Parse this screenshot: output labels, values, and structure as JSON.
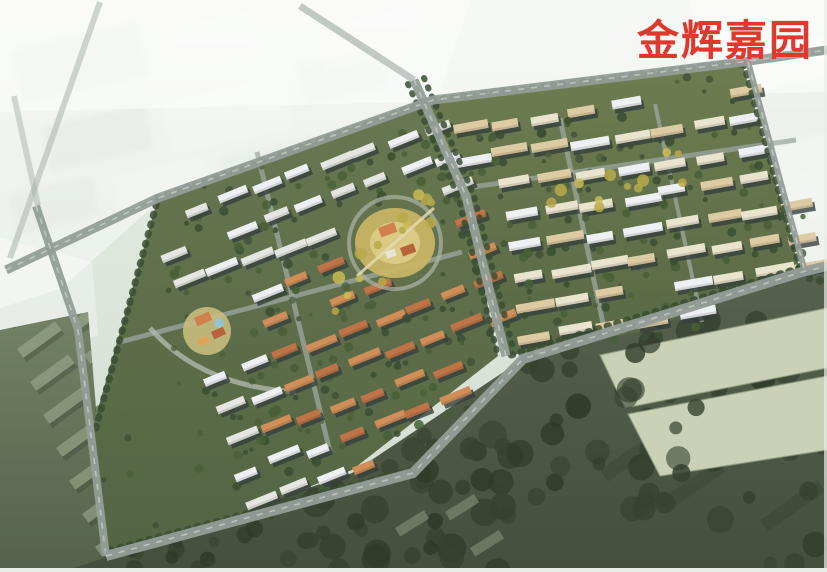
{
  "title": {
    "text": "金辉嘉园",
    "color": "#df392e"
  },
  "scene": {
    "width": 827,
    "height": 572,
    "seed": 13,
    "palette": {
      "haze_top": "#ecf1ea",
      "haze_mid": "#dce6db",
      "haze_bot": "#cfdacd",
      "haze_block": "#c7d3c9",
      "haze_white": "#eef3ee",
      "haze_road": "#a7b1a9",
      "lowland_top": "#6e7d5f",
      "lowland_bot": "#4e5c44",
      "lowland_slab": "#9cab8d",
      "lowland_shadow": "#323d2c",
      "forest_top": "#505c46",
      "forest_bot": "#3d4937",
      "forest_tree": "#2f3b28",
      "forest_tree_dark": "#273320",
      "site_w_top": "#62734a",
      "site_w_bot": "#4d5e3c",
      "site_e_top": "#687849",
      "site_e_bot": "#52633f",
      "tree_dark": "#33462b",
      "tree_mid": "#41582f",
      "tree_yellow": "#b5a743",
      "tree_yellow2": "#c9b94e",
      "roof_white": "#eef1f4",
      "roof_light": "#e3e7e0",
      "roof_cream": "#e9e3cd",
      "roof_tan": "#dcc9a0",
      "roof_orange": "#cf8a52",
      "roof_orange_dark": "#bc6f40",
      "wall_shadow": "#2e3835",
      "road_gray": "#8f9a94",
      "road_minor": "#9aa49c",
      "road_curve": "#aeb6aa",
      "plaza_outer": "#c9b35f",
      "plaza_inner": "#dbc981",
      "plaza_ring": "#a9b2a4",
      "plaza_path": "#e3d9ad",
      "pav1": "#cf7b43",
      "pav2": "#b35c33",
      "pav3": "#e7e3d2",
      "pav4": "#e0a14e",
      "pool": "#8fc3d4",
      "kinder_base": "#c6b97b",
      "warehouse": "#c7d1b4",
      "warehouse_shade": "#8d9a7e",
      "wash": "#ffffff",
      "border": "#e9ece8"
    },
    "haze": {
      "blocks": [
        [
          15,
          35,
          130,
          55,
          -13,
          "haze_block",
          0.5
        ],
        [
          165,
          18,
          95,
          48,
          -13,
          "haze_white",
          0.5
        ],
        [
          45,
          115,
          105,
          45,
          -13,
          "haze_block",
          0.45
        ],
        [
          165,
          90,
          125,
          52,
          -13,
          "haze_white",
          0.45
        ],
        [
          300,
          55,
          85,
          42,
          -13,
          "haze_block",
          0.4
        ],
        [
          12,
          185,
          85,
          40,
          -13,
          "haze_block",
          0.4
        ],
        [
          115,
          165,
          95,
          45,
          -13,
          "haze_white",
          0.4
        ],
        [
          225,
          145,
          100,
          48,
          -13,
          "haze_block",
          0.35
        ],
        [
          320,
          15,
          95,
          45,
          -13,
          "haze_white",
          0.4
        ],
        [
          335,
          120,
          80,
          40,
          -13,
          "haze_block",
          0.3
        ],
        [
          755,
          85,
          75,
          55,
          -13,
          "haze_block",
          0.35
        ],
        [
          762,
          175,
          65,
          48,
          -13,
          "haze_white",
          0.35
        ]
      ],
      "washes": [
        {
          "pts": [
            [
              0,
              0
            ],
            [
              827,
              0
            ],
            [
              827,
              92
            ],
            [
              0,
              112
            ]
          ],
          "op": 0.5
        },
        {
          "pts": [
            [
              0,
              0
            ],
            [
              470,
              0
            ],
            [
              436,
              104
            ],
            [
              162,
              198
            ],
            [
              62,
              288
            ],
            [
              0,
              308
            ]
          ],
          "op": 0.45
        },
        {
          "pts": [
            [
              0,
              238
            ],
            [
              92,
              262
            ],
            [
              98,
              336
            ],
            [
              0,
              352
            ]
          ],
          "op": 0.35
        },
        {
          "pts": [
            [
              738,
              52
            ],
            [
              827,
              38
            ],
            [
              827,
              278
            ],
            [
              798,
              272
            ]
          ],
          "op": 0.5
        },
        {
          "pts": [
            [
              690,
              0
            ],
            [
              827,
              0
            ],
            [
              827,
              60
            ],
            [
              700,
              62
            ]
          ],
          "op": 0.45
        }
      ],
      "roads": [
        [
          10,
          258,
          100,
          2,
          6,
          0.55
        ],
        [
          38,
          206,
          14,
          96,
          6,
          0.5
        ],
        [
          300,
          6,
          414,
          80,
          7,
          0.7
        ]
      ]
    },
    "lowland": {
      "poly": [
        [
          0,
          330
        ],
        [
          88,
          312
        ],
        [
          98,
          432
        ],
        [
          106,
          558
        ],
        [
          60,
          572
        ],
        [
          0,
          572
        ]
      ],
      "slabs": {
        "rows": 8,
        "cols": 3,
        "x0": 4,
        "y0": 316,
        "dxRow": 13,
        "dyRow": 33,
        "dxCol": 54,
        "dyCol": -27,
        "w": 47,
        "h": 11,
        "rot": -36
      }
    },
    "forest": {
      "poly": [
        [
          60,
          572
        ],
        [
          104,
          558
        ],
        [
          352,
          473
        ],
        [
          523,
          359
        ],
        [
          802,
          272
        ],
        [
          827,
          266
        ],
        [
          827,
          572
        ]
      ],
      "clusters": [
        {
          "n": 40,
          "x": [
            295,
            520
          ],
          "y": [
            430,
            572
          ],
          "r": [
            7,
            15
          ]
        },
        {
          "n": 45,
          "x": [
            520,
            827
          ],
          "y": [
            300,
            572
          ],
          "r": [
            6,
            14
          ]
        },
        {
          "n": 14,
          "x": [
            90,
            300
          ],
          "y": [
            470,
            572
          ],
          "r": [
            4,
            9
          ]
        }
      ],
      "shadow_streaks": [
        [
          600,
          470
        ],
        [
          660,
          500
        ],
        [
          710,
          450
        ],
        [
          760,
          520
        ]
      ],
      "small_slabs": [
        [
          395,
          528
        ],
        [
          445,
          512
        ],
        [
          470,
          548
        ]
      ],
      "warehouses": [
        [
          [
            600,
            355
          ],
          [
            827,
            308
          ],
          [
            827,
            368
          ],
          [
            625,
            408
          ]
        ],
        [
          [
            628,
            414
          ],
          [
            827,
            376
          ],
          [
            827,
            450
          ],
          [
            660,
            476
          ]
        ]
      ],
      "warehouse_trees": {
        "n": 16,
        "x": [
          548,
          700
        ],
        "y": [
          330,
          500
        ]
      }
    },
    "site": {
      "west": {
        "poly": [
          [
            92,
            430
          ],
          [
            158,
            198
          ],
          [
            433,
            100
          ],
          [
            468,
            208
          ],
          [
            498,
            356
          ],
          [
            352,
            470
          ],
          [
            240,
            514
          ],
          [
            106,
            556
          ]
        ],
        "origin": [
          150,
          222
        ],
        "u": [
          34,
          -11.7
        ],
        "v": [
          10.8,
          31.2
        ],
        "rows": 11,
        "cols": 10,
        "angle": -22,
        "barW": [
          22,
          34
        ],
        "barH": 8,
        "jitter": 3.5,
        "skip": 0.1,
        "fills": [
          "roof_white",
          "roof_light"
        ],
        "orange_poly": [
          [
            258,
            256
          ],
          [
            470,
            206
          ],
          [
            500,
            354
          ],
          [
            352,
            468
          ],
          [
            260,
            428
          ]
        ],
        "orange_fills": [
          "roof_orange",
          "roof_orange_dark"
        ],
        "exclude": [
          [
            395,
            243,
            50
          ],
          [
            207,
            331,
            30
          ]
        ],
        "extra_trees": 55
      },
      "east": {
        "poly": [
          [
            433,
            100
          ],
          [
            742,
            62
          ],
          [
            800,
            270
          ],
          [
            640,
            332
          ],
          [
            506,
            356
          ]
        ],
        "origin": [
          450,
          126
        ],
        "u": [
          39.6,
          -5.6
        ],
        "v": [
          4.3,
          30.7
        ],
        "rows": 9,
        "cols": 9,
        "angle": -10,
        "barW": [
          26,
          40
        ],
        "barH": 9,
        "jitter": 3.5,
        "skip": 0.1,
        "fills": [
          "roof_cream",
          "roof_white",
          "roof_tan"
        ],
        "orange_poly": null,
        "orange_fills": [],
        "exclude": [
          [
            395,
            243,
            52
          ]
        ],
        "extra_trees": 55
      },
      "belts": [
        {
          "pts": [
            [
              158,
              198
            ],
            [
              433,
              100
            ]
          ],
          "w": 7
        },
        {
          "pts": [
            [
              96,
              428
            ],
            [
              158,
              198
            ]
          ],
          "w": 7
        },
        {
          "pts": [
            [
              110,
              550
            ],
            [
              410,
              470
            ]
          ],
          "w": 7
        },
        {
          "pts": [
            [
              433,
              100
            ],
            [
              742,
              62
            ]
          ],
          "w": 7
        },
        {
          "pts": [
            [
              744,
              64
            ],
            [
              800,
              268
            ]
          ],
          "w": 7
        },
        {
          "pts": [
            [
              800,
              268
            ],
            [
              508,
              356
            ]
          ],
          "w": 7
        },
        {
          "pts": [
            [
              408,
              84
            ],
            [
              458,
              196
            ],
            [
              498,
              356
            ]
          ],
          "w": 6
        },
        {
          "pts": [
            [
              424,
              78
            ],
            [
              474,
              196
            ],
            [
              514,
              352
            ]
          ],
          "w": 6
        }
      ],
      "roads_major": [
        {
          "pts": [
            [
              6,
              270
            ],
            [
              158,
              198
            ],
            [
              433,
              100
            ],
            [
              742,
              62
            ],
            [
              827,
              50
            ]
          ],
          "w": 9
        },
        {
          "pts": [
            [
              36,
              206
            ],
            [
              78,
              330
            ],
            [
              106,
              556
            ]
          ],
          "w": 8
        },
        {
          "pts": [
            [
              106,
              556
            ],
            [
              413,
              473
            ],
            [
              523,
              359
            ],
            [
              802,
              272
            ],
            [
              827,
              266
            ]
          ],
          "w": 10
        },
        {
          "pts": [
            [
              414,
              80
            ],
            [
              466,
              196
            ],
            [
              506,
              356
            ]
          ],
          "w": 9
        },
        {
          "pts": [
            [
              748,
              62
            ],
            [
              804,
              268
            ]
          ],
          "w": 6
        }
      ],
      "roads_minor": [
        {
          "pts": [
            [
              120,
              342
            ],
            [
              462,
              252
            ]
          ],
          "w": 5
        },
        {
          "pts": [
            [
              257,
              152
            ],
            [
              330,
              452
            ]
          ],
          "w": 5
        },
        {
          "pts": [
            [
              452,
              190
            ],
            [
              796,
              140
            ]
          ],
          "w": 5
        },
        {
          "pts": [
            [
              560,
              118
            ],
            [
              606,
              338
            ]
          ],
          "w": 5
        },
        {
          "pts": [
            [
              655,
              104
            ],
            [
              702,
              322
            ]
          ],
          "w": 4
        }
      ],
      "curve_road": "M150,328 Q200,386 296,392",
      "plaza": {
        "cx": 395,
        "cy": 243,
        "ring_r": 46,
        "rx": 40,
        "ry": 35,
        "irx": 25,
        "iry": 21,
        "pav": [
          [
            378,
            228,
            17,
            10
          ],
          [
            400,
            248,
            14,
            9
          ],
          [
            385,
            252,
            10,
            7
          ]
        ],
        "pav_rot": -20,
        "path": [
          [
            357,
            276
          ],
          [
            434,
            208
          ]
        ]
      },
      "kinder": {
        "cx": 207,
        "cy": 331,
        "r": 24,
        "pav": [
          [
            194,
            318,
            16,
            9
          ],
          [
            211,
            332,
            13,
            8
          ],
          [
            197,
            340,
            11,
            7
          ]
        ],
        "pav_rot": -24,
        "pool": [
          219,
          323,
          5
        ]
      },
      "yellow": [
        {
          "a": [
            352,
            296
          ],
          "b": [
            436,
            188
          ],
          "n": 14,
          "jit": 24
        },
        {
          "a": [
            540,
            214
          ],
          "b": [
            694,
            152
          ],
          "n": 12,
          "jit": 20
        }
      ]
    }
  }
}
